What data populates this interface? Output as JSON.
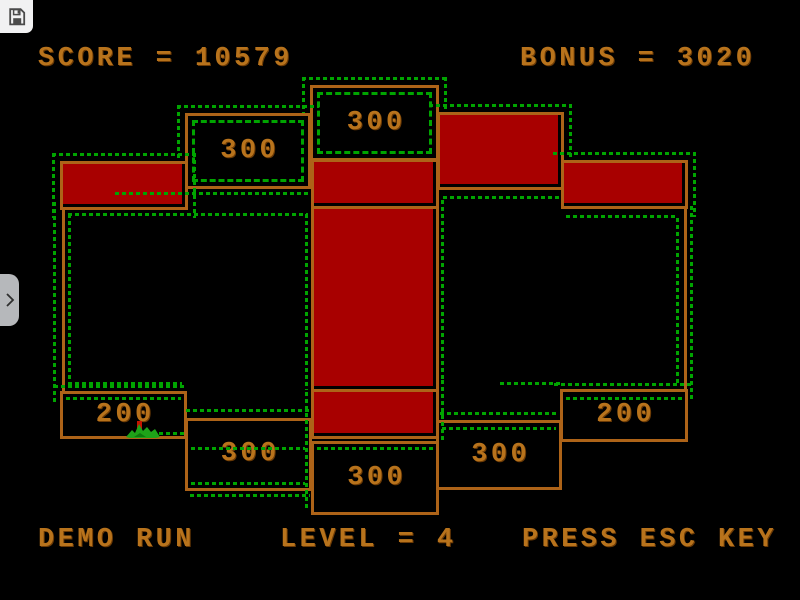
{
  "hud": {
    "score_text": "SCORE = 10579",
    "bonus_text": "BONUS = 3020",
    "demo_text": "DEMO RUN",
    "level_text": "LEVEL = 4",
    "esc_text": "PRESS ESC KEY"
  },
  "chrome": {
    "save_icon": "floppy-disk",
    "sidebar_toggle_icon": "chevron-right"
  },
  "colors": {
    "bg": "#000000",
    "orange": "#ad6318",
    "text": "#b8731c",
    "red": "#a80000",
    "green": "#00a400",
    "chrome": "#f1f1f2",
    "tab": "#b6b8bb",
    "icon": "#4a4a4a",
    "creature_green": "#1ea318",
    "creature_red": "#c41400"
  },
  "playfield": {
    "boxes": [
      {
        "name": "zone-300-top-center",
        "kind": "zone",
        "value": "300",
        "x": 310,
        "y": 85,
        "w": 129,
        "h": 76,
        "inner": true,
        "outer": [
          "top",
          "left",
          "right"
        ]
      },
      {
        "name": "zone-300-top-left",
        "kind": "zone",
        "value": "300",
        "x": 185,
        "y": 113,
        "w": 126,
        "h": 76,
        "inner": true,
        "outer": [
          "top",
          "left"
        ]
      },
      {
        "name": "claimed-left",
        "kind": "claimed",
        "x": 60,
        "y": 161,
        "w": 128,
        "h": 49,
        "outer": [
          "top",
          "left",
          "right"
        ]
      },
      {
        "name": "claimed-top-right",
        "kind": "claimed",
        "x": 437,
        "y": 112,
        "w": 127,
        "h": 78,
        "outer": [
          "top",
          "right"
        ]
      },
      {
        "name": "claimed-right",
        "kind": "claimed",
        "x": 561,
        "y": 160,
        "w": 127,
        "h": 49,
        "outer": [
          "top",
          "right"
        ]
      },
      {
        "name": "claimed-center-top",
        "kind": "claimed",
        "x": 311,
        "y": 159,
        "w": 128,
        "h": 50,
        "outer": []
      },
      {
        "name": "claimed-center-middle",
        "kind": "claimed",
        "x": 311,
        "y": 206,
        "w": 128,
        "h": 186,
        "outer": []
      },
      {
        "name": "claimed-center-bottom",
        "kind": "claimed",
        "x": 311,
        "y": 389,
        "w": 128,
        "h": 50,
        "outer": []
      },
      {
        "name": "zone-200-bottom-left",
        "kind": "zone",
        "value": "200",
        "x": 60,
        "y": 391,
        "w": 127,
        "h": 48,
        "outer": []
      },
      {
        "name": "zone-300-bottom-left",
        "kind": "zone",
        "value": "300",
        "x": 185,
        "y": 418,
        "w": 127,
        "h": 73,
        "outer": []
      },
      {
        "name": "zone-300-bottom-center",
        "kind": "zone",
        "value": "300",
        "x": 311,
        "y": 441,
        "w": 128,
        "h": 74,
        "outer": []
      },
      {
        "name": "zone-300-bottom-right",
        "kind": "zone",
        "value": "300",
        "x": 436,
        "y": 420,
        "w": 126,
        "h": 70,
        "outer": []
      },
      {
        "name": "zone-200-bottom-right",
        "kind": "zone",
        "value": "200",
        "x": 560,
        "y": 389,
        "w": 128,
        "h": 53,
        "outer": []
      }
    ],
    "lines": [
      {
        "x": 62,
        "y": 209,
        "w": 3,
        "h": 185
      },
      {
        "x": 684,
        "y": 208,
        "w": 3,
        "h": 184
      }
    ],
    "ants": [
      {
        "x": 115,
        "y": 192,
        "w": 196,
        "h": 3
      },
      {
        "x": 53,
        "y": 202,
        "w": 3,
        "h": 200
      },
      {
        "x": 68,
        "y": 213,
        "w": 240,
        "h": 3
      },
      {
        "x": 68,
        "y": 214,
        "w": 3,
        "h": 170
      },
      {
        "x": 68,
        "y": 382,
        "w": 114,
        "h": 3
      },
      {
        "x": 305,
        "y": 214,
        "w": 3,
        "h": 176
      },
      {
        "x": 54,
        "y": 385,
        "w": 130,
        "h": 3
      },
      {
        "x": 66,
        "y": 397,
        "w": 115,
        "h": 3
      },
      {
        "x": 145,
        "y": 432,
        "w": 40,
        "h": 3
      },
      {
        "x": 186,
        "y": 409,
        "w": 126,
        "h": 3
      },
      {
        "x": 191,
        "y": 447,
        "w": 114,
        "h": 3
      },
      {
        "x": 191,
        "y": 482,
        "w": 114,
        "h": 3
      },
      {
        "x": 190,
        "y": 494,
        "w": 120,
        "h": 3
      },
      {
        "x": 317,
        "y": 447,
        "w": 116,
        "h": 3
      },
      {
        "x": 305,
        "y": 392,
        "w": 3,
        "h": 116
      },
      {
        "x": 441,
        "y": 380,
        "w": 3,
        "h": 60
      },
      {
        "x": 443,
        "y": 196,
        "w": 116,
        "h": 3
      },
      {
        "x": 566,
        "y": 215,
        "w": 112,
        "h": 3
      },
      {
        "x": 441,
        "y": 200,
        "w": 3,
        "h": 182
      },
      {
        "x": 676,
        "y": 218,
        "w": 3,
        "h": 166
      },
      {
        "x": 690,
        "y": 206,
        "w": 3,
        "h": 194
      },
      {
        "x": 500,
        "y": 382,
        "w": 60,
        "h": 3
      },
      {
        "x": 554,
        "y": 383,
        "w": 140,
        "h": 3
      },
      {
        "x": 566,
        "y": 397,
        "w": 116,
        "h": 3
      },
      {
        "x": 440,
        "y": 412,
        "w": 118,
        "h": 3
      },
      {
        "x": 442,
        "y": 427,
        "w": 114,
        "h": 3
      }
    ],
    "creature": {
      "x": 126,
      "y": 420,
      "w": 36,
      "h": 19
    }
  }
}
